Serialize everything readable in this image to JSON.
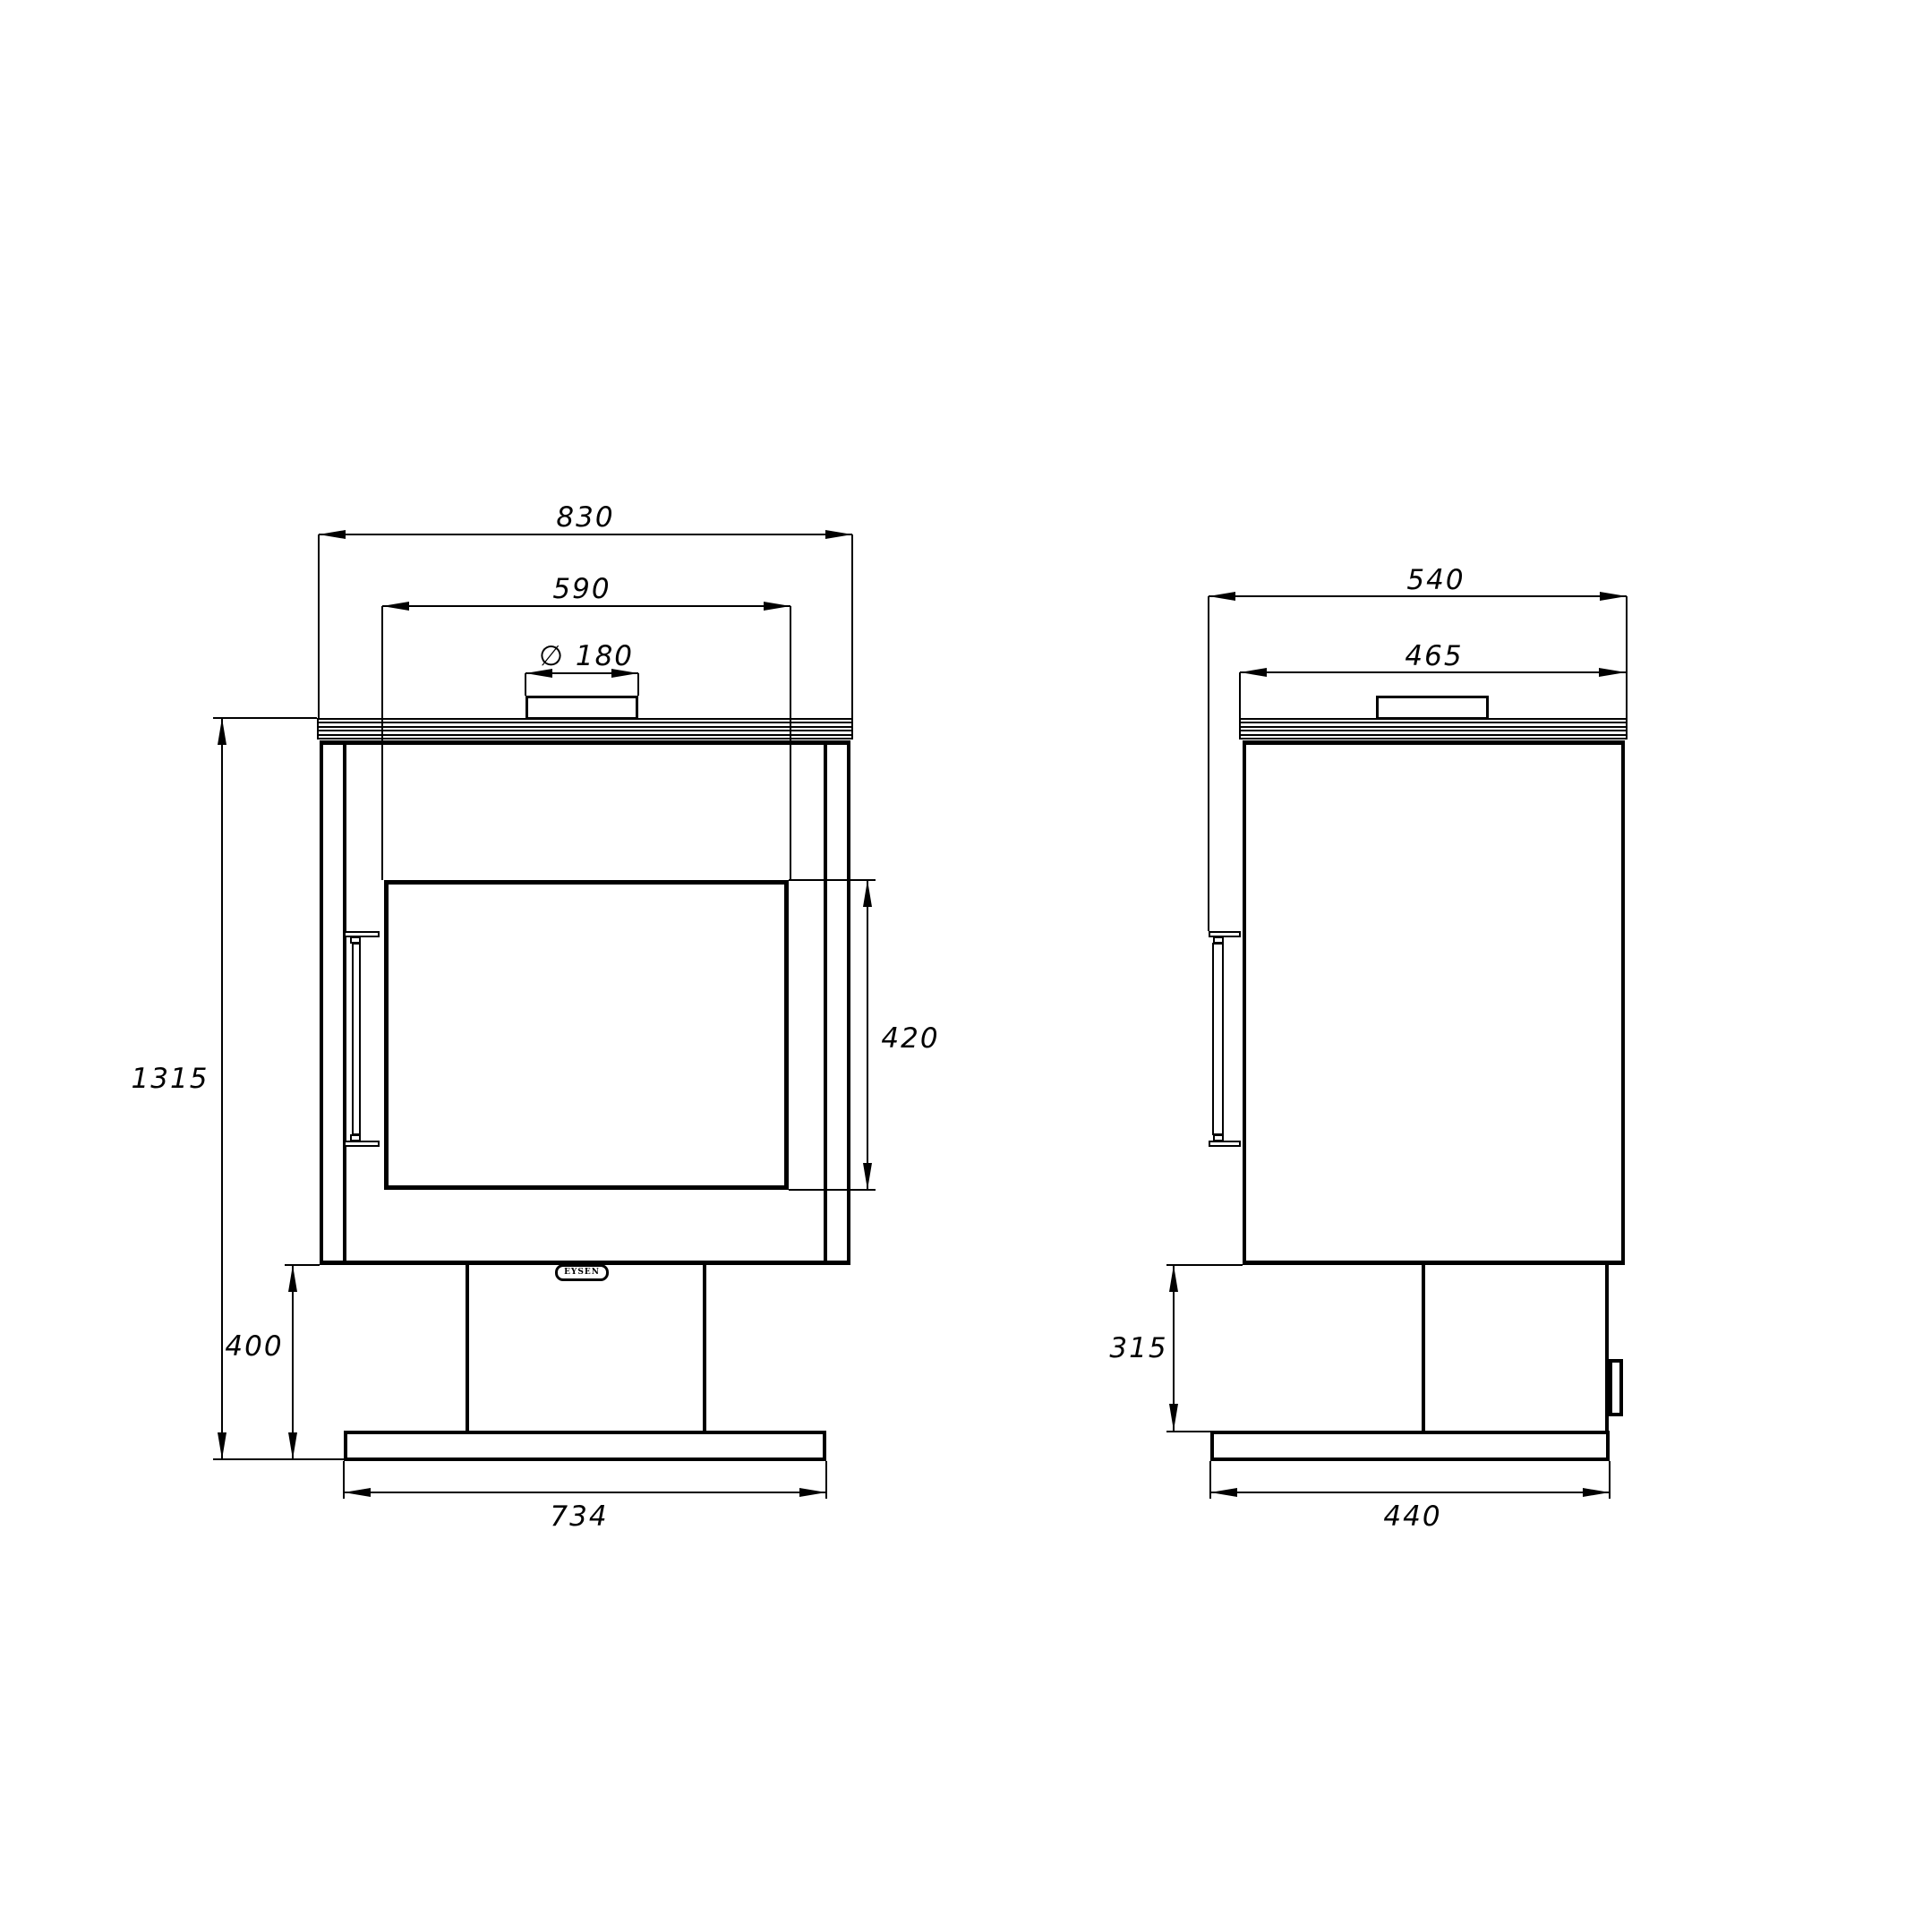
{
  "drawing": {
    "brand_label": "EYSEN",
    "front_view": {
      "dim_total_width": "830",
      "dim_door_width": "590",
      "dim_flue_diameter": "∅ 180",
      "dim_total_height": "1315",
      "dim_glass_height": "420",
      "dim_pedestal_height": "400",
      "dim_base_width": "734"
    },
    "side_view": {
      "dim_total_depth": "540",
      "dim_body_depth": "465",
      "dim_pedestal_height": "315",
      "dim_base_depth": "440"
    }
  }
}
